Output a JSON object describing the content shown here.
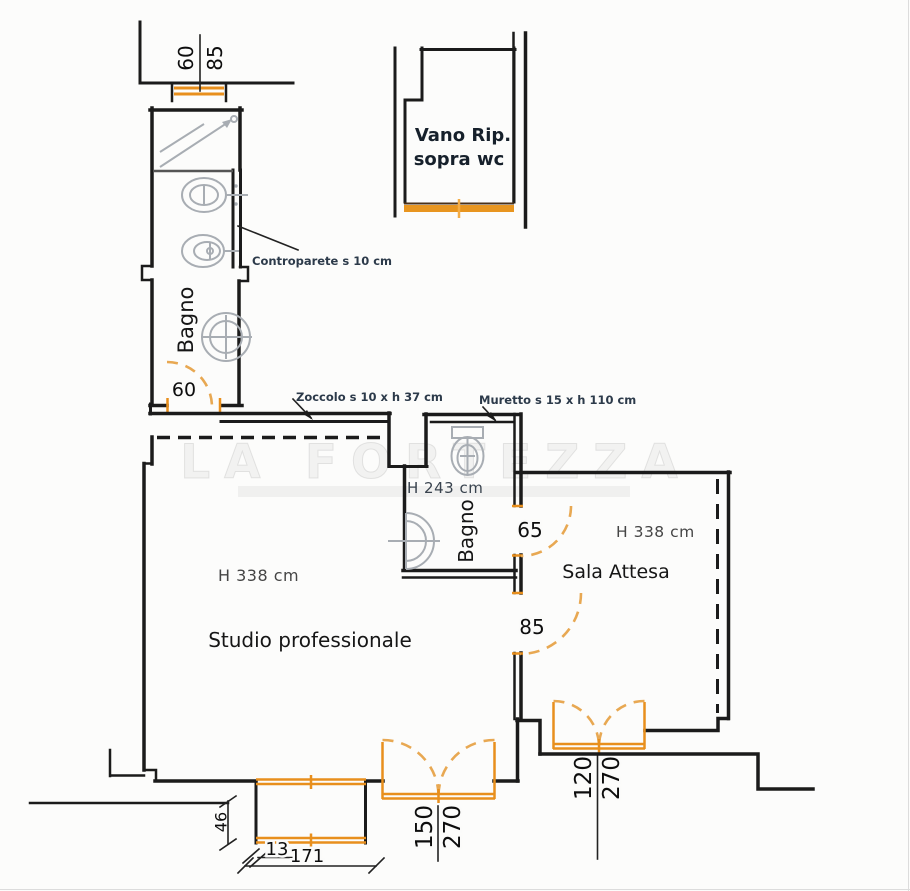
{
  "plan": {
    "watermark": "LA FORTEZZA",
    "rooms": {
      "bagno1": {
        "label": "Bagno",
        "door": "60"
      },
      "bagno2": {
        "label": "Bagno",
        "height": "H 243 cm",
        "door": "65"
      },
      "studio": {
        "label": "Studio professionale",
        "height": "H 338 cm",
        "door": "85"
      },
      "sala": {
        "label": "Sala Attesa",
        "height": "H 338 cm"
      },
      "vano": {
        "line1": "Vano Rip.",
        "line2": "sopra wc"
      }
    },
    "annotations": {
      "controparete": "Controparete s 10 cm",
      "zoccolo": "Zoccolo s 10 x h 37 cm",
      "muretto": "Muretto s 15 x h 110 cm"
    },
    "dims": {
      "window_w": "60",
      "window_h": "85",
      "studio_door_w": "150",
      "studio_door_h": "270",
      "sala_door_w": "120",
      "sala_door_h": "270",
      "bay_depth": "46",
      "bay_offset": "13",
      "bay_width": "171"
    },
    "colors": {
      "wall": "#1b1b1b",
      "accent": "#e88f1d",
      "fixture": "#a8adb3"
    }
  }
}
